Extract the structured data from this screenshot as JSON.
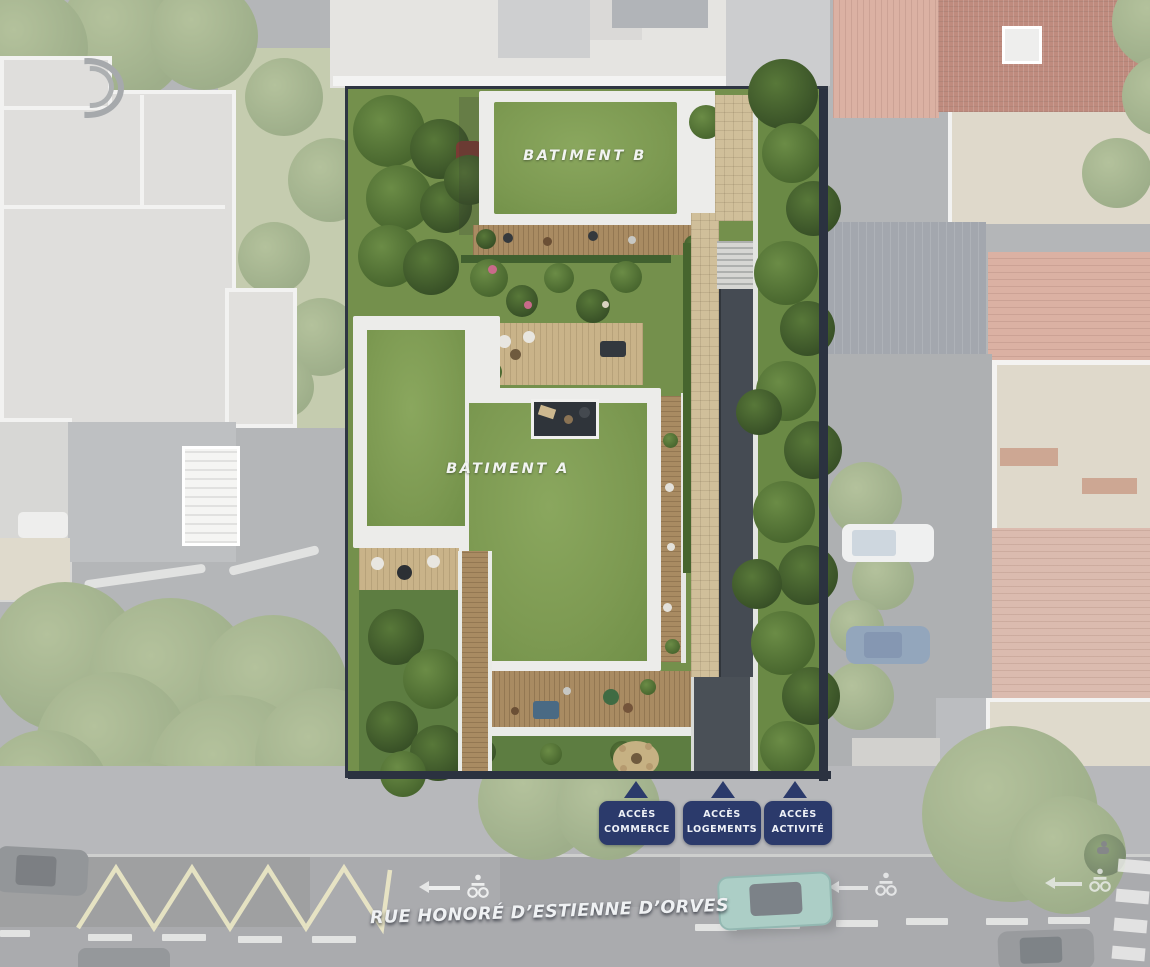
{
  "site_plan": {
    "buildings": [
      {
        "id": "A",
        "label": "BATIMENT A"
      },
      {
        "id": "B",
        "label": "BATIMENT B"
      }
    ],
    "access_points": [
      {
        "line1": "ACCÈS",
        "line2": "COMMERCE"
      },
      {
        "line1": "ACCÈS",
        "line2": "LOGEMENTS"
      },
      {
        "line1": "ACCÈS",
        "line2": "ACTIVITÉ"
      }
    ],
    "street": {
      "name": "RUE HONORÉ D’ESTIENNE D’ORVES"
    },
    "icons": {
      "access_marker": "up-triangle-marker",
      "bike_lane": "cyclist-road-marking",
      "direction": "left-arrow-road-marking",
      "no_parking": "yellow-zigzag-marking",
      "crossing": "crosswalk-stripes"
    },
    "colors": {
      "access_badge_navy": "#2b3a6b",
      "green_roof": "#7d9a52",
      "site_lawn": "#74904c",
      "wood_deck": "#a98b62",
      "pavement_beige": "#d0bf9a",
      "parapet_white": "#ececea",
      "road_gray": "#9a9ca0",
      "terracotta_roof": "#d8ad9e"
    }
  }
}
